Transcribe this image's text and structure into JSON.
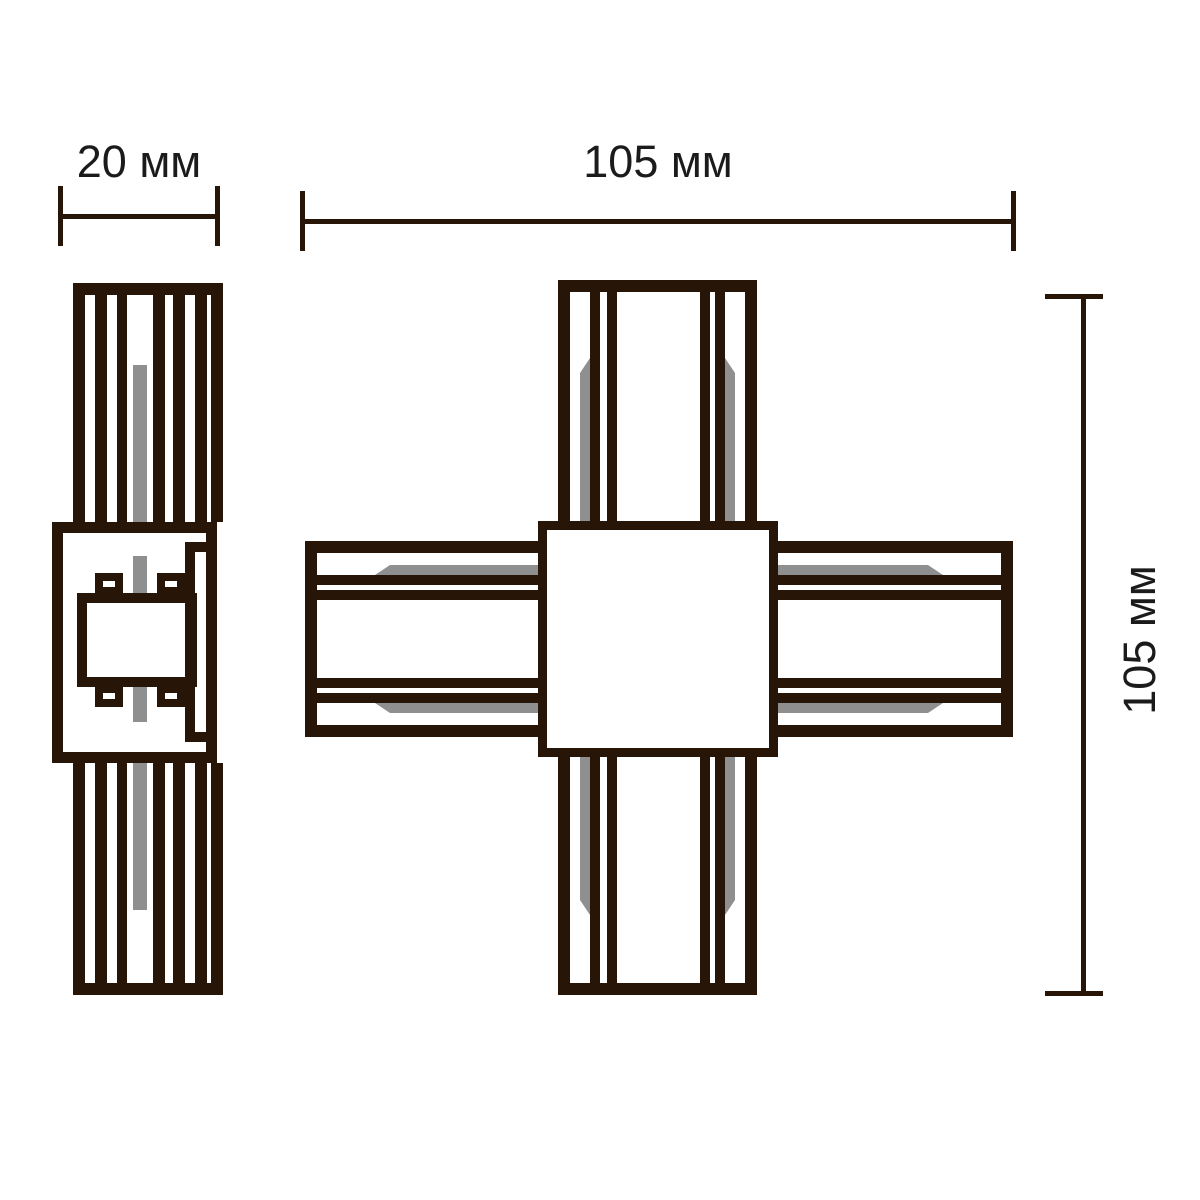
{
  "labels": {
    "side_width": "20 мм",
    "front_width": "105 мм",
    "front_height": "105 мм"
  },
  "colors": {
    "line": "#271507",
    "conductor": "#8f8f8f",
    "text": "#1b1b1b",
    "background": "#ffffff"
  }
}
